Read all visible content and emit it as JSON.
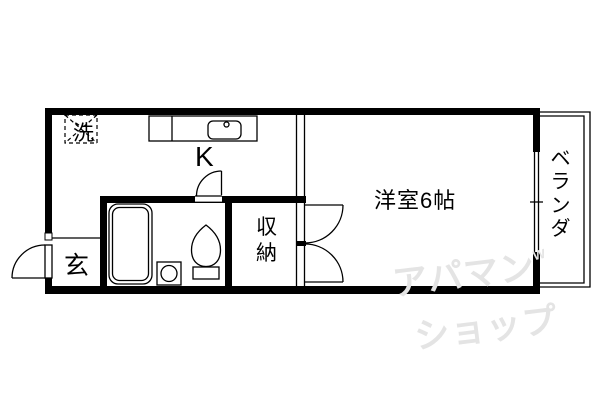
{
  "meta": {
    "type": "floor-plan",
    "layout_name": "1K apartment floor plan"
  },
  "colors": {
    "line": "#000000",
    "bg": "#ffffff",
    "watermark": "#e4e4e4"
  },
  "rooms": {
    "kitchen": {
      "label": "K"
    },
    "western_room": {
      "label": "洋室6帖",
      "size_tatami": "6帖"
    },
    "entrance": {
      "label": "玄"
    },
    "closet": {
      "label": "収納"
    },
    "veranda": {
      "label": "ベランダ"
    },
    "washer_space": {
      "label": "洗"
    }
  },
  "fixtures": [
    "washing-machine-space",
    "kitchen-counter-with-sink",
    "bathtub",
    "washbasin",
    "toilet",
    "entrance-door",
    "bathroom-door",
    "closet-double-doors",
    "sliding-window"
  ],
  "watermark": {
    "line1": "アパマン",
    "line2": "ショップ",
    "mark": "W"
  }
}
